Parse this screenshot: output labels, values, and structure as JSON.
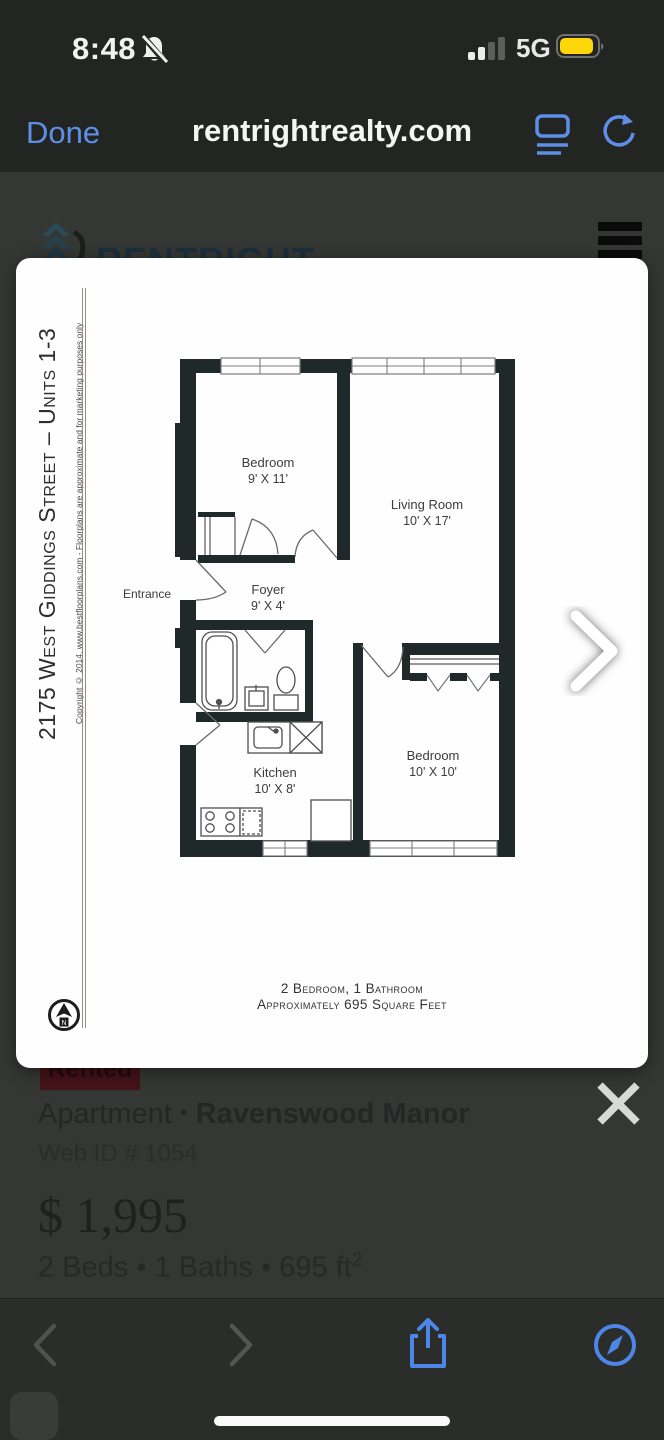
{
  "status_bar": {
    "time": "8:48",
    "network": "5G",
    "battery_color": "#ffd60a",
    "notifications_muted": true
  },
  "safari": {
    "done_label": "Done",
    "url": "rentrightrealty.com",
    "accent": "#5d8fe8"
  },
  "background_page": {
    "brand": "RENTRIGHT",
    "logo_color": "#2a4a56"
  },
  "lightbox": {
    "floorplan": {
      "title_vertical": "2175 West Giddings Street – Units 1-3",
      "copyright": "Copyright © 2014, www.bestfloorplans.com - Floorplans are approximate and for marketing purposes only",
      "entrance_label": "Entrance",
      "rooms": [
        {
          "name": "Bedroom",
          "dims": "9' X 11'"
        },
        {
          "name": "Living Room",
          "dims": "10' X 17'"
        },
        {
          "name": "Foyer",
          "dims": "9' X 4'"
        },
        {
          "name": "Kitchen",
          "dims": "10' X 8'"
        },
        {
          "name": "Bedroom",
          "dims": "10' X 10'"
        }
      ],
      "caption_line1": "2 Bedroom, 1 Bathroom",
      "caption_line2": "Approximately 695 Square Feet",
      "compass_n": "N",
      "wall_color": "#1f2929"
    }
  },
  "listing": {
    "badge_label": "Rented",
    "type": "Apartment",
    "dot": "•",
    "neighborhood": "Ravenswood Manor",
    "web_id": "Web ID # 1054",
    "price": "$ 1,995",
    "beds_baths_sqft": "2 Beds • 1 Baths • 695 ft",
    "sqft_superscript": "2"
  }
}
